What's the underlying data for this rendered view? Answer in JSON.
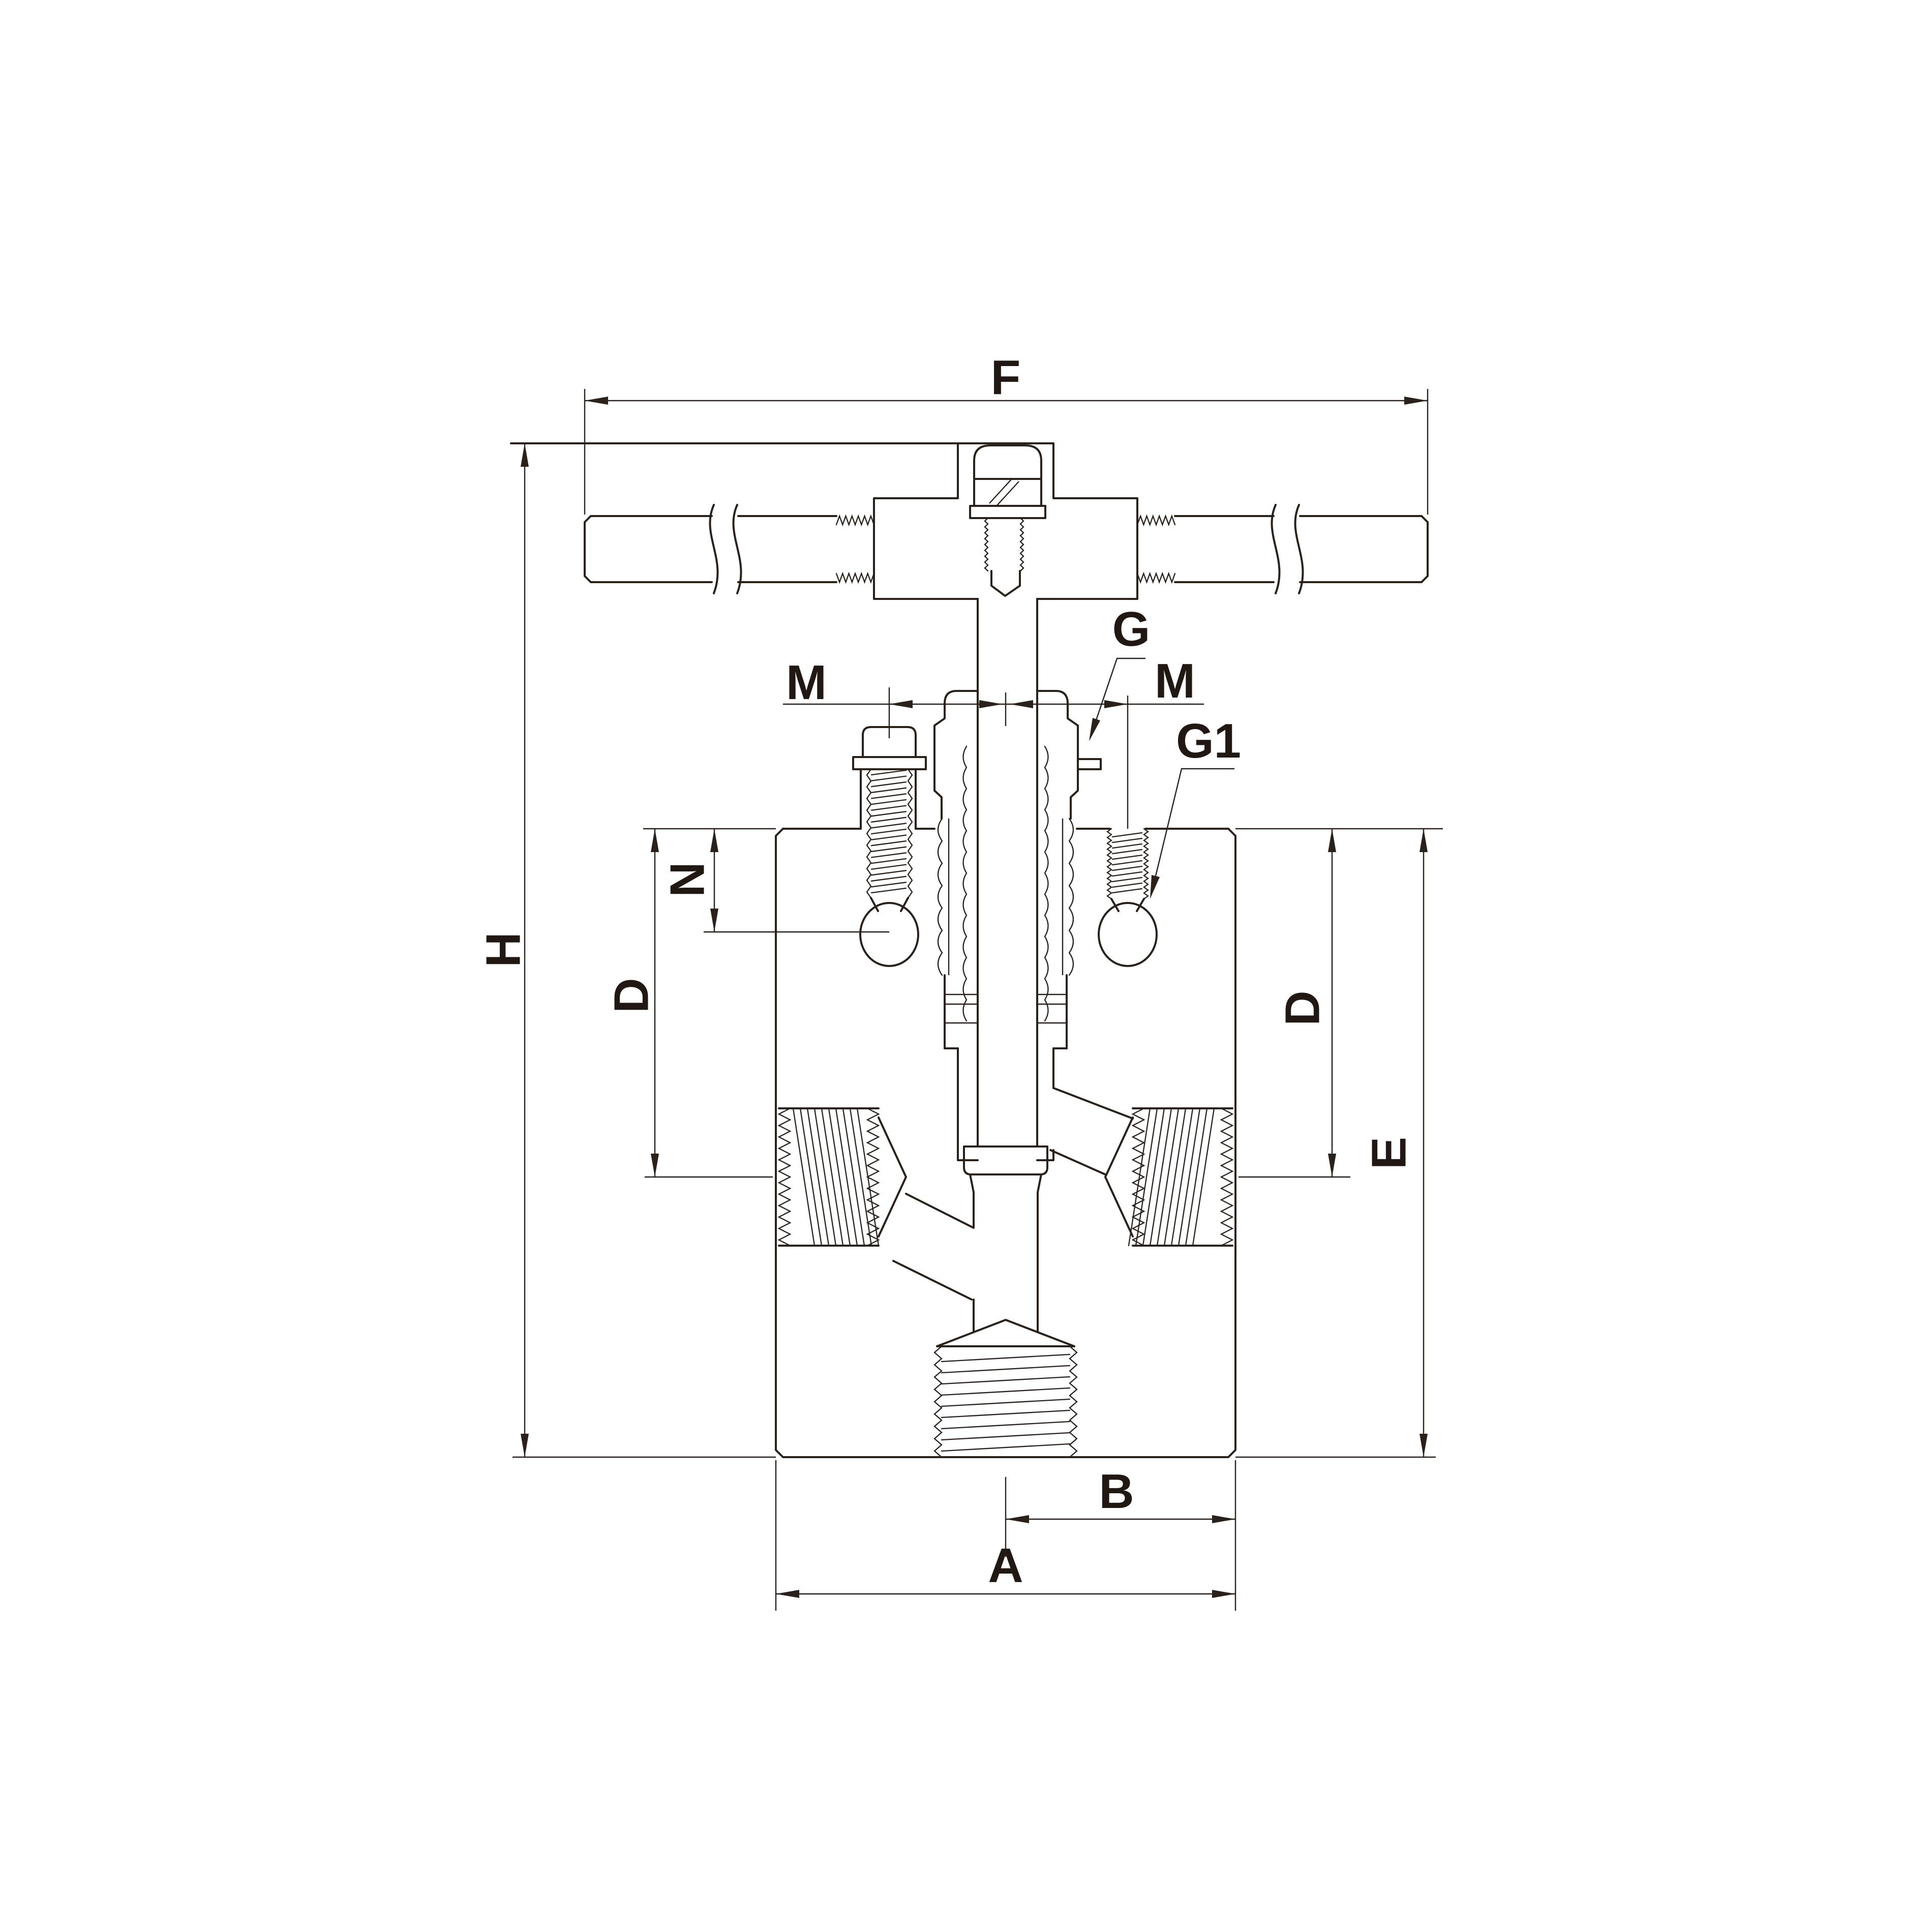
{
  "drawing": {
    "kind": "valve cross-section dimensional drawing",
    "background": "#ffffff",
    "line_color": "#2b211b",
    "labels": {
      "f": "F",
      "h": "H",
      "m_left": "M",
      "m_right": "M",
      "g": "G",
      "g1": "G1",
      "n": "N",
      "d_left": "D",
      "d_right": "D",
      "e": "E",
      "b": "B",
      "a": "A"
    }
  }
}
